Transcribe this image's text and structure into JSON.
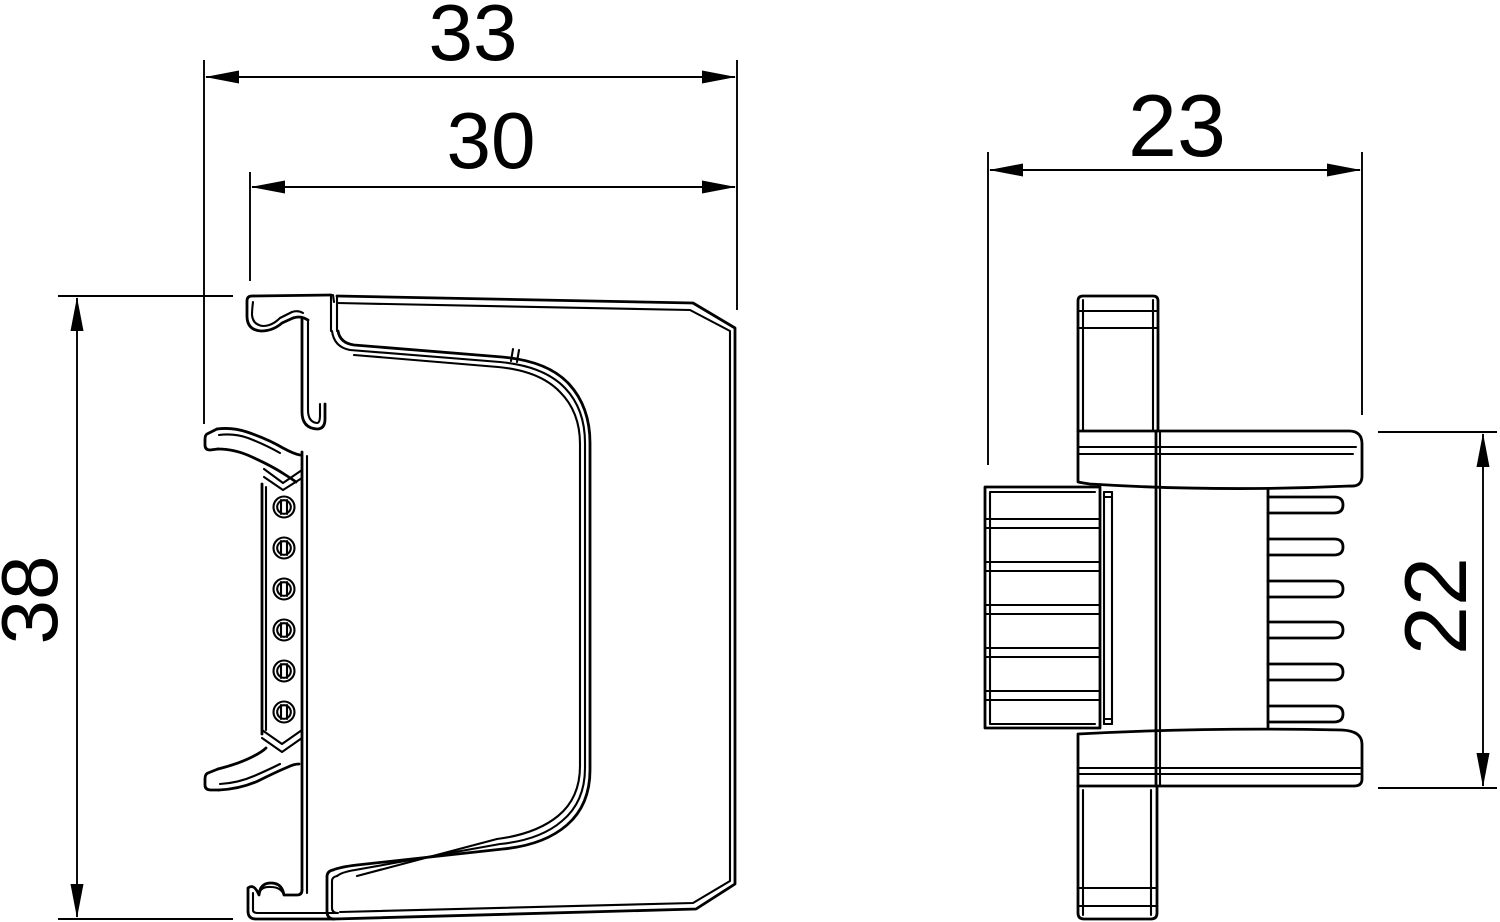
{
  "drawing": {
    "type": "technical-dimension-drawing",
    "views": 2,
    "colors": {
      "line": "#000000",
      "background": "#ffffff"
    },
    "dims": {
      "overall_width": {
        "label": "33"
      },
      "inner_width": {
        "label": "30"
      },
      "overall_height": {
        "label": "38"
      },
      "side_width": {
        "label": "23"
      },
      "side_height": {
        "label": "22"
      }
    }
  }
}
